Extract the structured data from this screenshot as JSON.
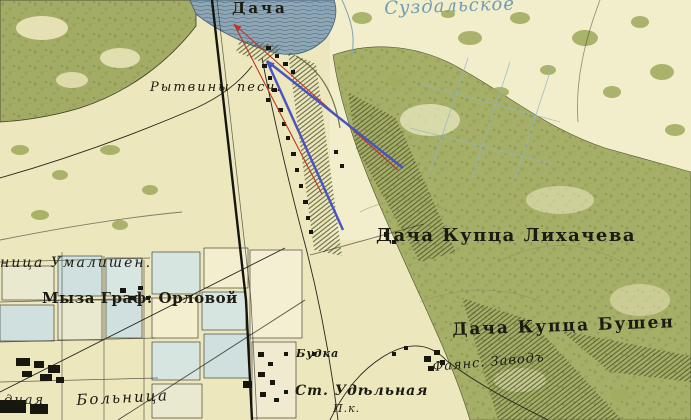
{
  "map": {
    "title": "Historical topographic map, Udelnaya area (St. Petersburg)",
    "labels": [
      {
        "id": "dacha-top",
        "text": "Дача"
      },
      {
        "id": "zav-frag",
        "text": "Зав."
      },
      {
        "id": "suzdalskoe",
        "text": "Суздальское"
      },
      {
        "id": "rytviny",
        "text": "Рытвины песч."
      },
      {
        "id": "likhachev",
        "text": "Дача Купца Лихачева"
      },
      {
        "id": "bushen",
        "text": "Дача Купца Бушен"
      },
      {
        "id": "umalishen",
        "text": "ница Умалишен."
      },
      {
        "id": "myza-orlova",
        "text": "Мыза Граф: Орловой"
      },
      {
        "id": "budka",
        "text": "Будка"
      },
      {
        "id": "st-udelnaya",
        "text": "Ст. Удѣльная"
      },
      {
        "id": "pk",
        "text": "П.к."
      },
      {
        "id": "fayans",
        "text": "Фаянс. Заводъ"
      },
      {
        "id": "bolnitsa",
        "text": "Больница"
      },
      {
        "id": "dnaya-frag",
        "text": "дная"
      }
    ],
    "colors": {
      "parchment": "#ece7bd",
      "forest": "#a6af67",
      "forest_dark": "#6b7240",
      "water": "#8fa7b5",
      "water_line": "#5e7b90",
      "block_blue": "#cfe0de",
      "ink": "#1b1b12",
      "map_blue_text": "#6f9cb4",
      "hachure": "#50562e",
      "annotation_red": "#c03322",
      "annotation_blue": "#4853c4"
    },
    "annotations": {
      "arrows": [
        {
          "id": "red-arrow",
          "color": "#c03322",
          "width": 1.1,
          "apex": [
            234,
            24
          ],
          "ends": [
            [
              398,
              170
            ],
            [
              322,
              194
            ]
          ]
        },
        {
          "id": "blue-arrow",
          "color": "#4853c4",
          "width": 2.4,
          "apex": [
            267,
            61
          ],
          "ends": [
            [
              403,
              168
            ],
            [
              343,
              230
            ]
          ]
        }
      ]
    }
  }
}
